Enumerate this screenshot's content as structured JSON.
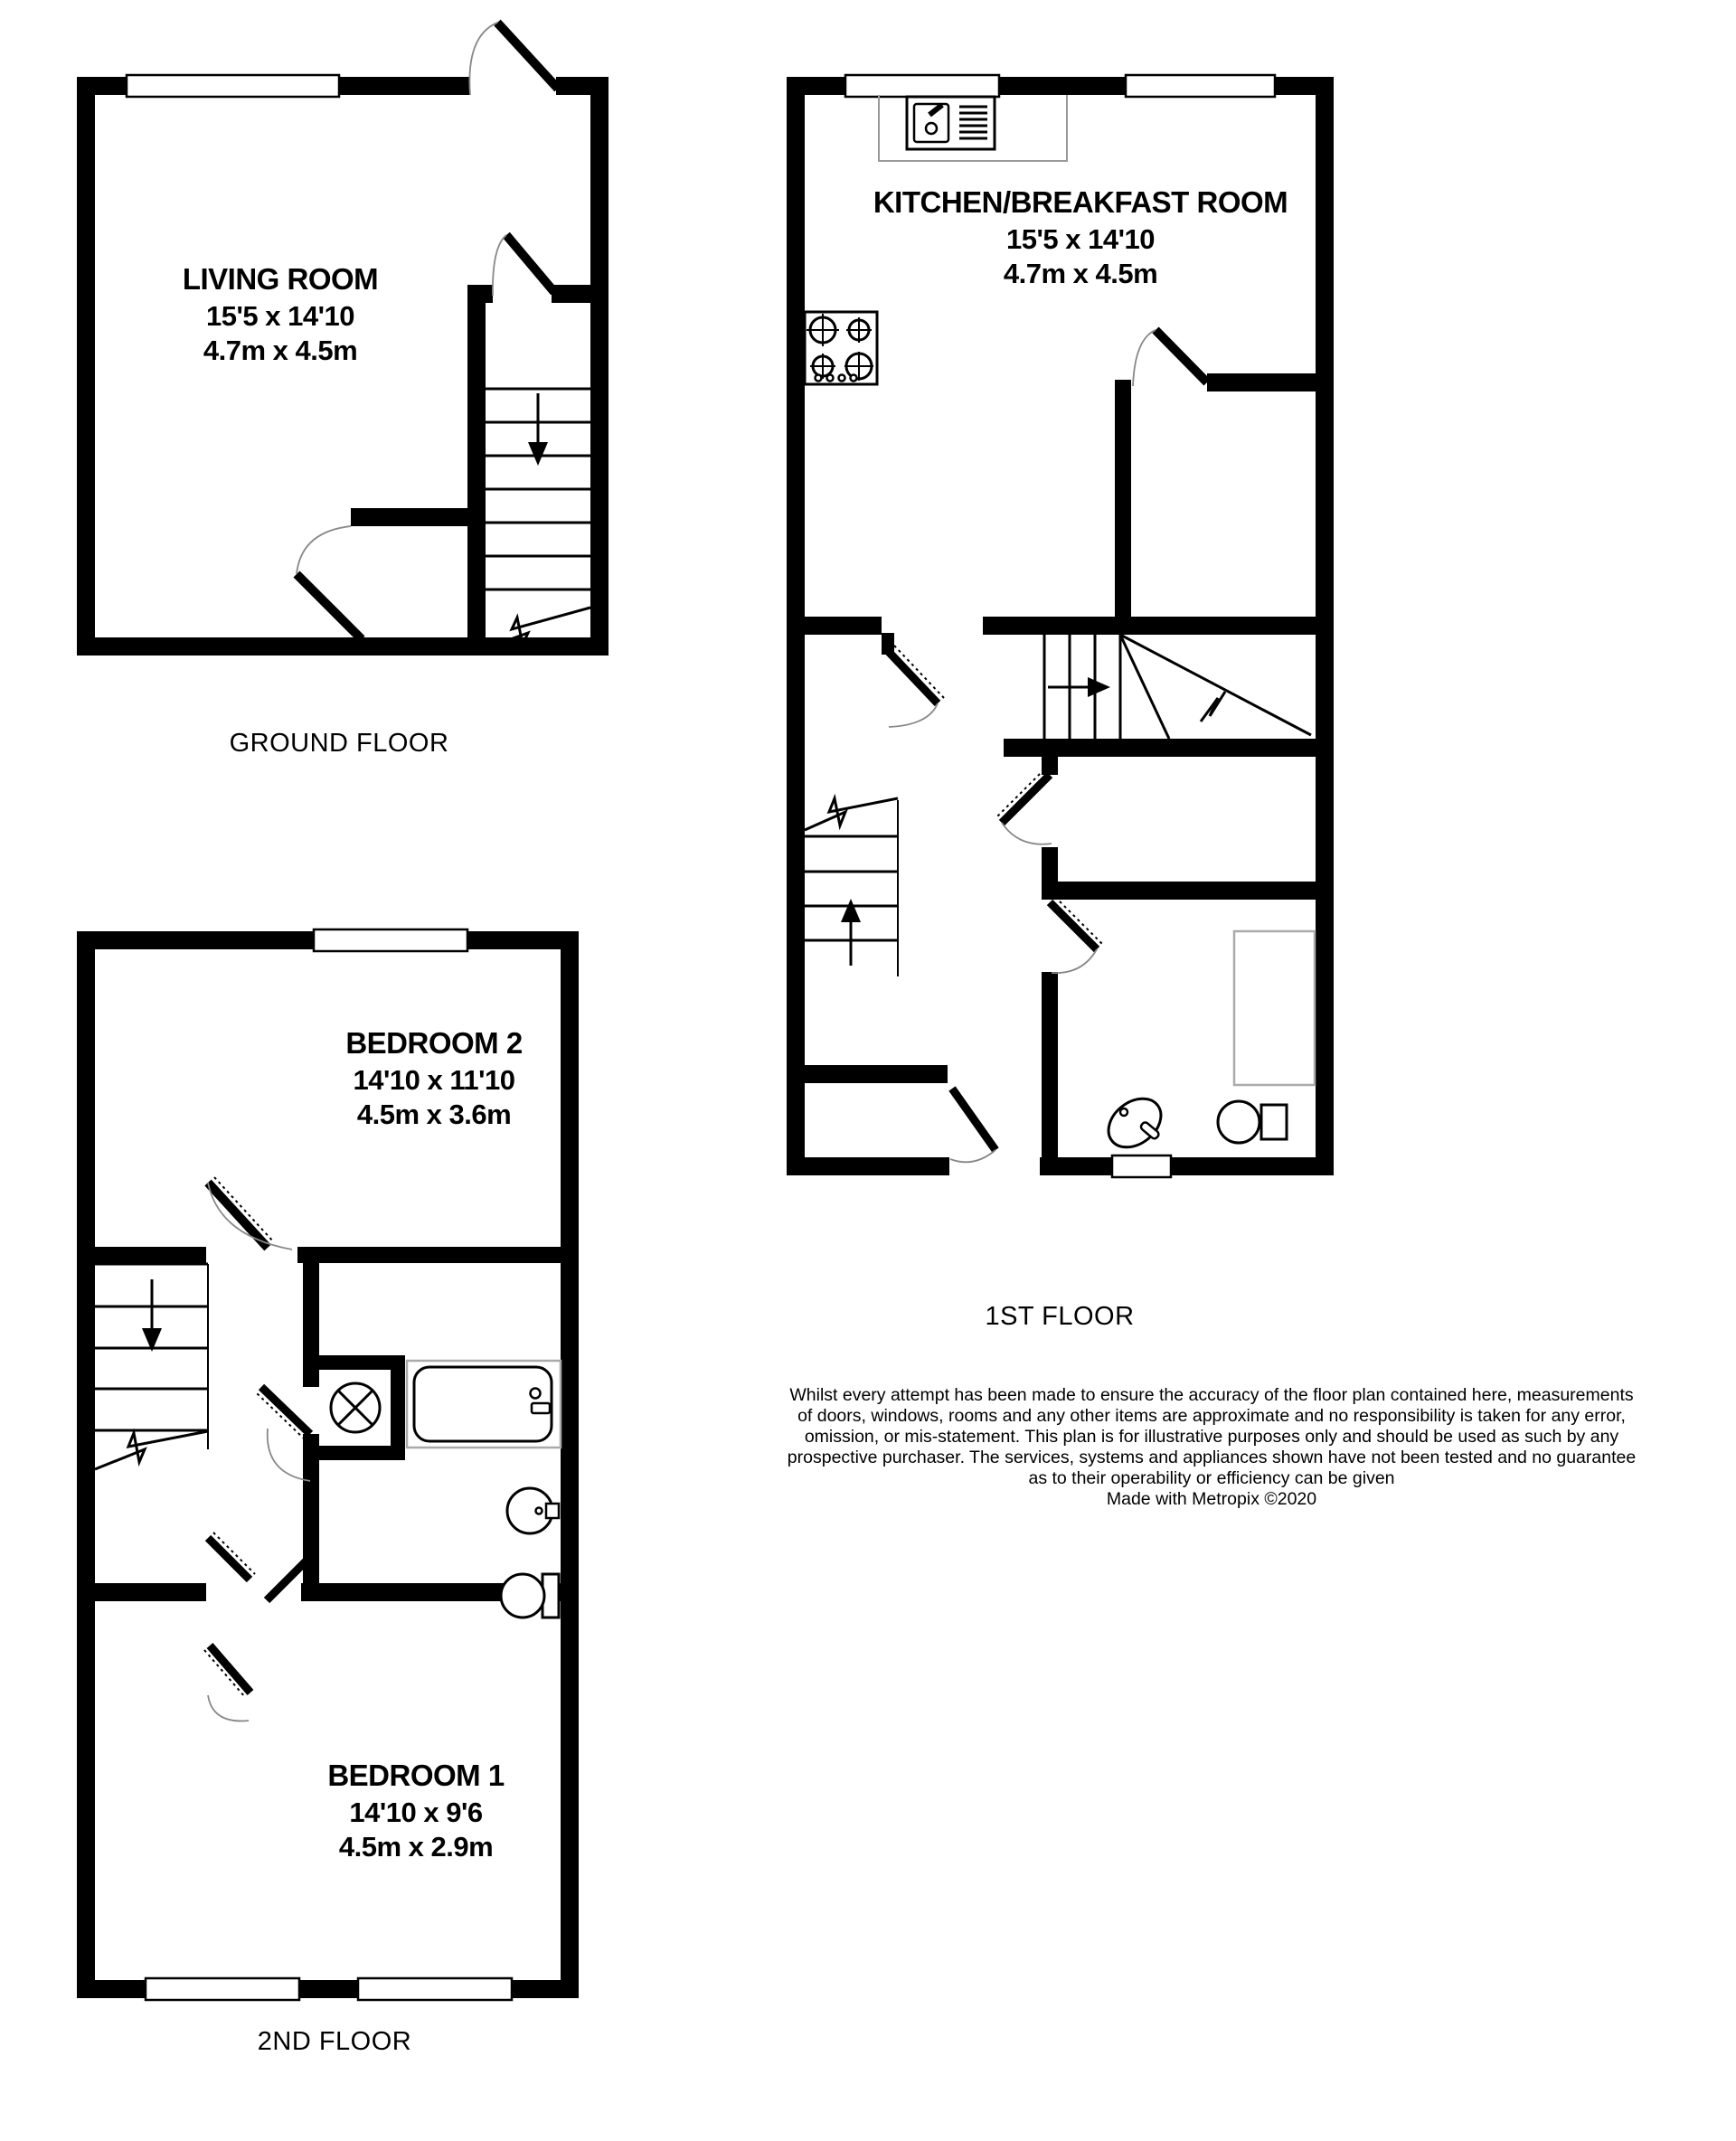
{
  "page": {
    "background": "#ffffff"
  },
  "colors": {
    "wall": "#000000",
    "door_arc": "#888888",
    "counter_line": "#999999",
    "cupboard_line": "#aaaaaa",
    "text": "#000000"
  },
  "floors": [
    {
      "label": "GROUND FLOOR",
      "rooms": [
        {
          "name": "LIVING ROOM",
          "size_imperial": "15'5 x 14'10",
          "size_metric": "4.7m x 4.5m"
        }
      ]
    },
    {
      "label": "1ST FLOOR",
      "rooms": [
        {
          "name": "KITCHEN/BREAKFAST ROOM",
          "size_imperial": "15'5 x 14'10",
          "size_metric": "4.7m x 4.5m"
        }
      ]
    },
    {
      "label": "2ND FLOOR",
      "rooms": [
        {
          "name": "BEDROOM 2",
          "size_imperial": "14'10 x 11'10",
          "size_metric": "4.5m x 3.6m"
        },
        {
          "name": "BEDROOM 1",
          "size_imperial": "14'10 x 9'6",
          "size_metric": "4.5m x 2.9m"
        }
      ]
    }
  ],
  "disclaimer": {
    "lines": [
      "Whilst every attempt has been made to ensure the accuracy of the floor plan contained here, measurements",
      "of doors, windows, rooms and any other items are approximate and no responsibility is taken for any error,",
      "omission, or mis-statement. This plan is for illustrative purposes only and should be used as such by any",
      "prospective purchaser. The services, systems and appliances shown have not been tested and no guarantee",
      "as to their operability or efficiency can be given",
      "Made with Metropix ©2020"
    ]
  }
}
